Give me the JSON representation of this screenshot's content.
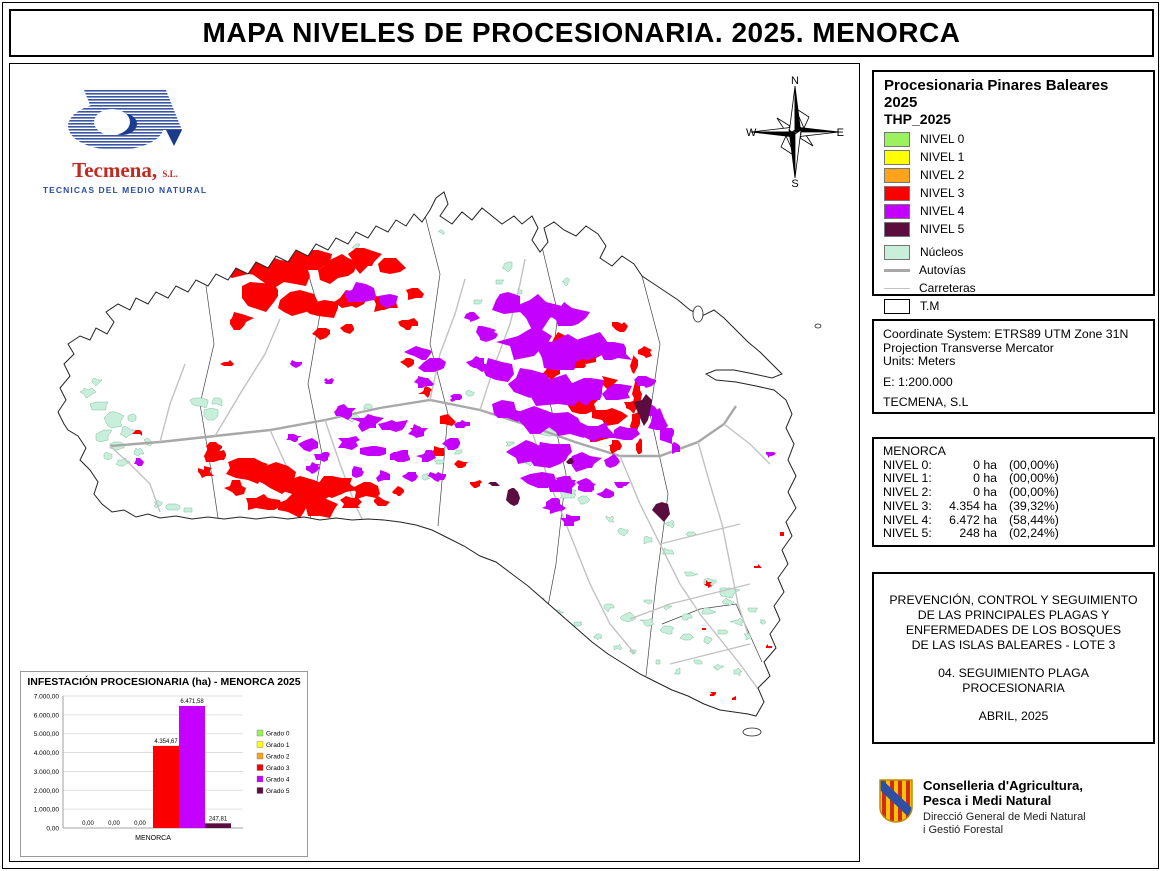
{
  "title": "MAPA NIVELES DE PROCESIONARIA. 2025. MENORCA",
  "legend": {
    "title": "Procesionaria Pinares Baleares 2025",
    "subtitle": "THP_2025",
    "levels": [
      {
        "label": "NIVEL 0",
        "color": "#9cf25e"
      },
      {
        "label": "NIVEL 1",
        "color": "#ffff00"
      },
      {
        "label": "NIVEL 2",
        "color": "#ffa21c"
      },
      {
        "label": "NIVEL 3",
        "color": "#fb0000"
      },
      {
        "label": "NIVEL 4",
        "color": "#c400ff"
      },
      {
        "label": "NIVEL 5",
        "color": "#5c0d3f"
      }
    ],
    "nucleos": {
      "label": "Núcleos",
      "color": "#c8efdc"
    },
    "autovias": {
      "label": "Autovías",
      "color": "#a8a8a8"
    },
    "carreteras": {
      "label": "Carreteras",
      "color": "#c2c2c2"
    },
    "tm": {
      "label": "T.M"
    }
  },
  "coordinate_box": {
    "line1": "Coordinate System: ETRS89 UTM Zone 31N",
    "line2": "Projection Transverse Mercator",
    "line3": "Units: Meters",
    "scale": "E: 1:200.000",
    "company": "TECMENA, S.L"
  },
  "stats_box": {
    "title": "MENORCA",
    "rows": [
      {
        "label": "NIVEL 0:",
        "ha": "0 ha",
        "pct": "(00,00%)"
      },
      {
        "label": "NIVEL 1:",
        "ha": "0 ha",
        "pct": "(00,00%)"
      },
      {
        "label": "NIVEL 2:",
        "ha": "0 ha",
        "pct": "(00,00%)"
      },
      {
        "label": "NIVEL 3:",
        "ha": "4.354 ha",
        "pct": "(39,32%)"
      },
      {
        "label": "NIVEL 4:",
        "ha": "6.472 ha",
        "pct": "(58,44%)"
      },
      {
        "label": "NIVEL 5:",
        "ha": "248 ha",
        "pct": "(02,24%)"
      }
    ]
  },
  "project_box": {
    "lines": [
      "PREVENCIÓN, CONTROL Y SEGUIMIENTO",
      "DE LAS PRINCIPALES PLAGAS Y",
      "ENFERMEDADES DE LOS BOSQUES",
      "DE LAS ISLAS BALEARES - LOTE 3"
    ],
    "subtitle": "04. SEGUIMIENTO PLAGA PROCESIONARIA",
    "date": "ABRIL, 2025"
  },
  "org_logo": {
    "name_line1": "Conselleria d'Agricultura,",
    "name_line2": "Pesca i Medi Natural",
    "dept_line1": "Direcció General de Medi Natural",
    "dept_line2": "i Gestió Forestal"
  },
  "tecmena_logo": {
    "name": "Tecmena,",
    "suffix": "S.L.",
    "tagline": "TECNICAS DEL MEDIO NATURAL"
  },
  "compass": {
    "n": "N",
    "s": "S",
    "e": "E",
    "w": "W"
  },
  "chart_data": {
    "type": "bar",
    "title": "INFESTACIÓN PROCESIONARIA (ha) - MENORCA 2025",
    "categories": [
      "MENORCA"
    ],
    "series": [
      {
        "name": "Grado 0",
        "color": "#9cf25e",
        "values": [
          0
        ],
        "label": "0,00"
      },
      {
        "name": "Grado 1",
        "color": "#ffff00",
        "values": [
          0
        ],
        "label": "0,00"
      },
      {
        "name": "Grado 2",
        "color": "#ffa21c",
        "values": [
          0
        ],
        "label": "0,00"
      },
      {
        "name": "Grado 3",
        "color": "#fb0000",
        "values": [
          4354.67
        ],
        "label": "4.354,67"
      },
      {
        "name": "Grado 4",
        "color": "#c400ff",
        "values": [
          6471.58
        ],
        "label": "6.471,58"
      },
      {
        "name": "Grado 5",
        "color": "#5c0d3f",
        "values": [
          247.81
        ],
        "label": "247,81"
      }
    ],
    "xlabel": "MENORCA",
    "ylabel": "",
    "ylim": [
      0,
      7000
    ],
    "ytick_step": 1000,
    "ytick_labels": [
      "0,00",
      "1.000,00",
      "2.000,00",
      "3.000,00",
      "4.000,00",
      "5.000,00",
      "6.000,00",
      "7.000,00"
    ],
    "grid": true,
    "legend_position": "right"
  }
}
